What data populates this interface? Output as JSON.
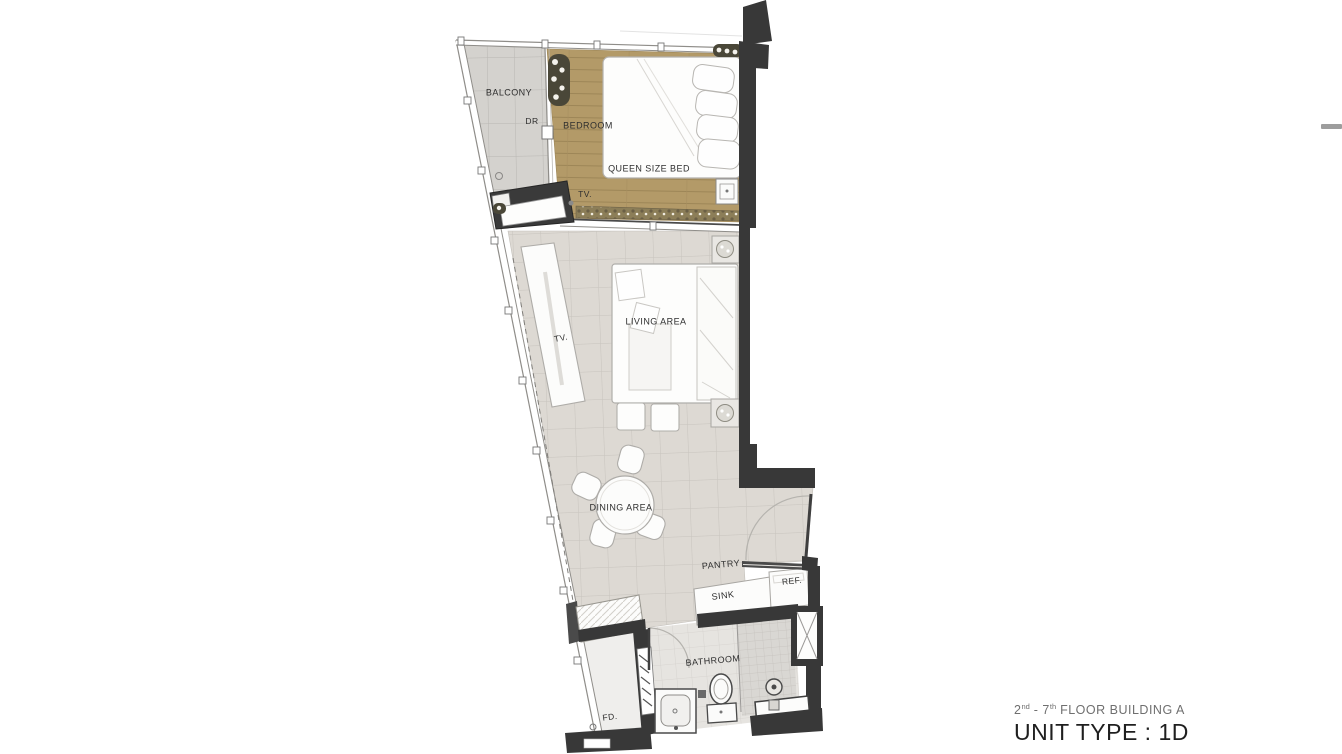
{
  "plan_labels": {
    "balcony": "BALCONY",
    "dr": "DR",
    "bedroom": "BEDROOM",
    "queen_bed": "QUEEN SIZE BED",
    "tv_bedroom": "TV.",
    "tv_living": "TV.",
    "living_area": "LIVING AREA",
    "dining_area": "DINING AREA",
    "pantry": "PANTRY",
    "refrigerator": "REF.",
    "sink": "SINK",
    "bathroom": "BATHROOM",
    "floor_drain": "FD."
  },
  "title_block": {
    "floor_line": {
      "num1": "2",
      "sup1": "nd",
      "dash": " - ",
      "num2": "7",
      "sup2": "th",
      "rest": " FLOOR BUILDING A"
    },
    "unit_line": "UNIT TYPE : 1D"
  },
  "colors": {
    "wall": "#383838",
    "wood_floor": "#b39a68",
    "tile_floor": "#ddd9d3",
    "balcony_floor": "#d4d2ce",
    "furniture": "#fcfcfb",
    "label_text": "#2e2e2e",
    "subtitle_text": "#6f6f6f",
    "title_text": "#1f1f1f"
  }
}
